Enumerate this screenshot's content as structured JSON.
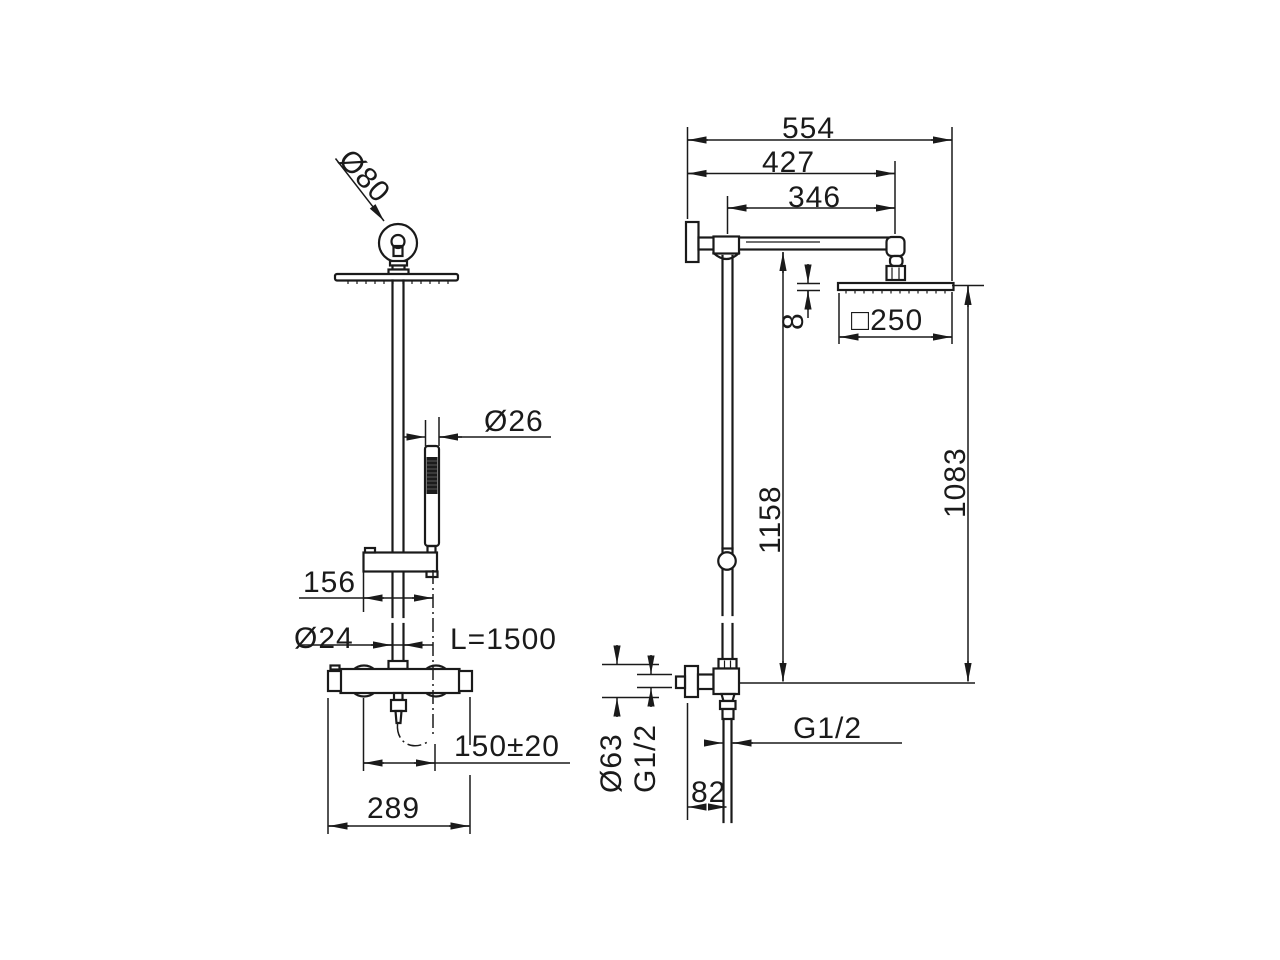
{
  "drawing": {
    "background": "#ffffff",
    "line_color": "#1a1a1a",
    "handle_fill": "#1b1b1b",
    "views": {
      "front": {
        "labels": {
          "ceiling_connection_dia": "Ø80",
          "hand_shower_dia": "Ø26",
          "bracket_offset": "156",
          "riser_pipe_dia": "Ø24",
          "hose_length": "L=1500",
          "inlet_distance": "150±20",
          "valve_width": "289"
        }
      },
      "side": {
        "labels": {
          "total_reach": "554",
          "arm_reach": "427",
          "arm_length": "346",
          "head_thickness": "8",
          "head_size": "□250",
          "height_to_arm": "1158",
          "height_to_head": "1083",
          "flange_dia": "Ø63",
          "flange_thread": "G1/2",
          "outlet_thread": "G1/2",
          "outlet_offset": "82"
        }
      }
    }
  }
}
